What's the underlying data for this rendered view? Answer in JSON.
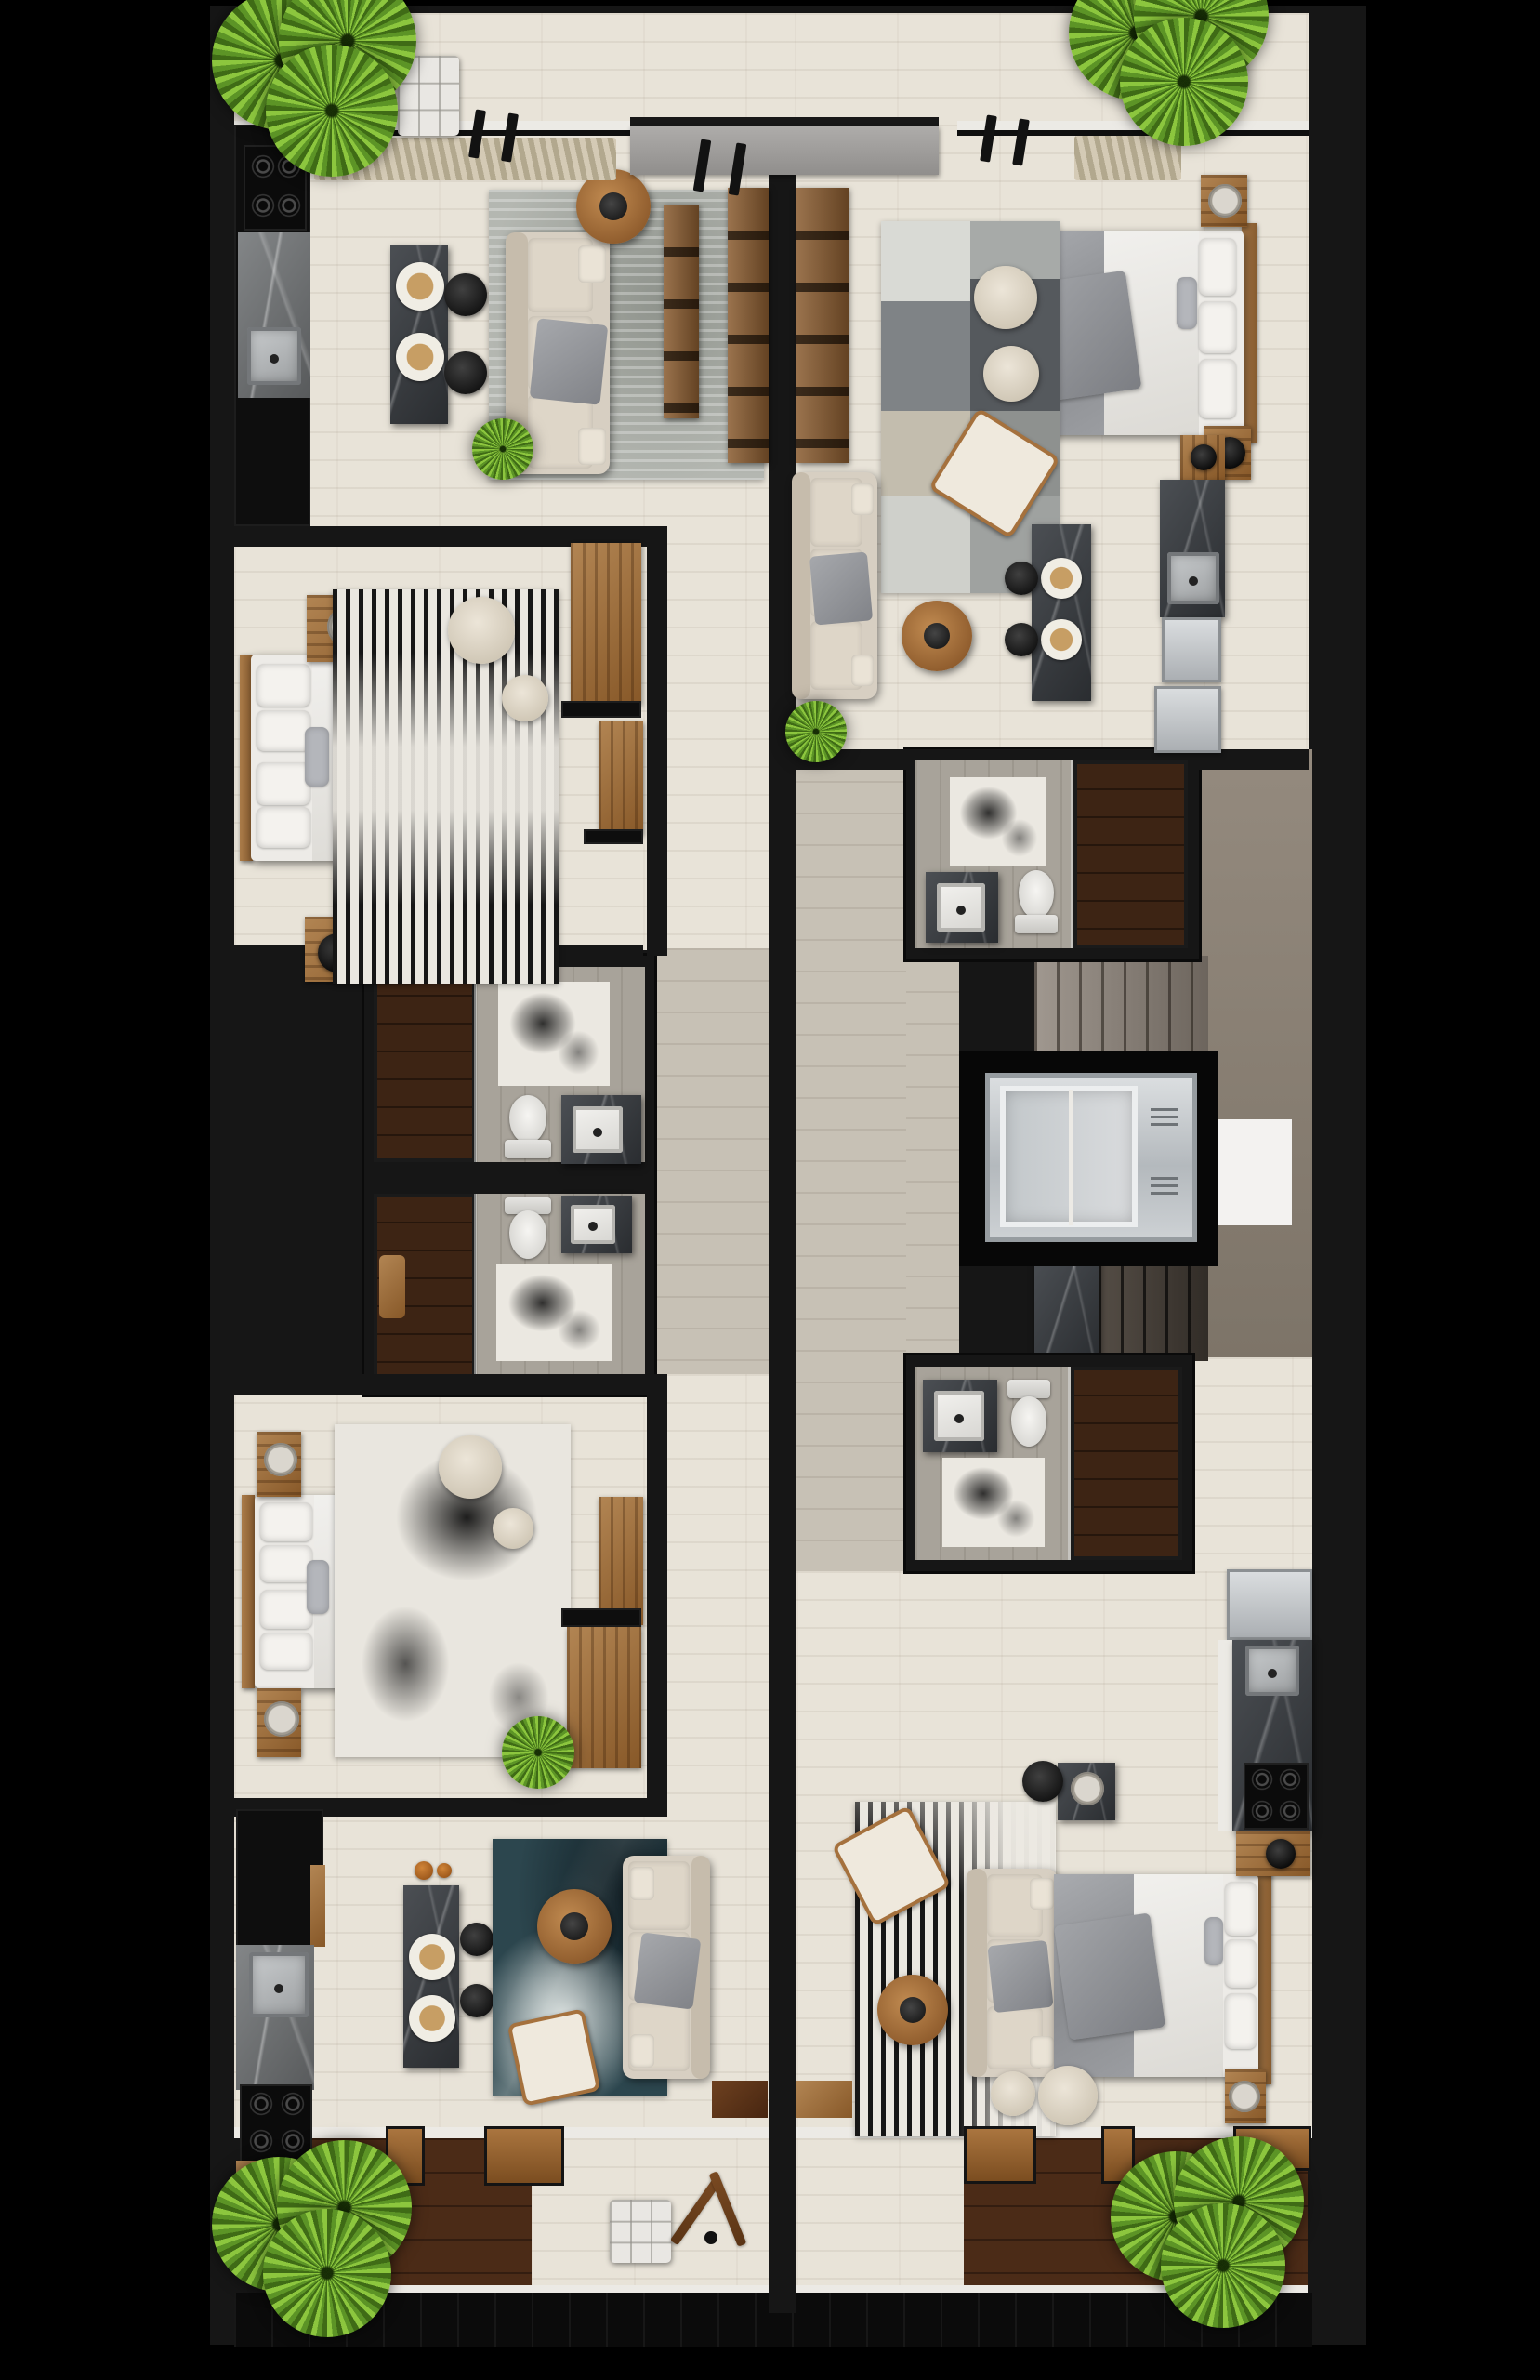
{
  "meta": {
    "title": "Residential floor plan — top-down 3D render",
    "view": "top-down",
    "style": "photorealistic 3D floor plan on black background",
    "apartments": 4,
    "shared_core": true
  },
  "palette": {
    "background": "#000000",
    "wall": "#161616",
    "floor_plank": "#e8e3d8",
    "hall_tile": "#c7c1b5",
    "bath_tile": "#a8a39a",
    "shower_wood": "#3d2414",
    "deck_wood": "#4b2b17",
    "warm_wood": "#a06a3b",
    "light_wood": "#b28553",
    "marble_dark": "#3c4045",
    "marble_gray": "#75787a",
    "sofa_beige": "#d7cfc2",
    "bedding_white": "#edebe7",
    "blanket_gray": "#97999d",
    "rug_gray": "#b4b7b1",
    "rug_blue": "#2c464e",
    "pouf_cream": "#e3dccd",
    "stool_black": "#242424",
    "plant_green": "#5c9426",
    "plant_light": "#8cc63e",
    "plant_dark": "#3f6b16",
    "elevator_silver": "#dde0e2",
    "stairs_taupe": "#8b8177",
    "concrete": "#8a8175",
    "curtain_beige": "#c9bfa7",
    "sill_white": "#eceae5"
  },
  "units": {
    "top_left": {
      "label": "Unit 1 · top-left · one-bedroom apartment",
      "rooms": [
        "open kitchen & dining",
        "living room",
        "bedroom",
        "bathroom",
        "balcony"
      ],
      "furniture": [
        "gas cooktop",
        "kitchen sink",
        "gray marble counter",
        "dark marble dining island",
        "2 place settings",
        "2 black bar stools",
        "beige sofa with gray throw",
        "gray area rug",
        "round wood coffee table",
        "TV shelf console",
        "double-sided wood media console",
        "tufted white ottoman",
        "window curtains",
        "double bed",
        "2 wood nightstands",
        "table lamp",
        "glass tray",
        "black & white striped rug",
        "2 round poufs",
        "wardrobe",
        "dresser",
        "walk-in shower",
        "toilet",
        "stone vanity with basin",
        "bath mat",
        "wood shower stool"
      ]
    },
    "top_right": {
      "label": "Unit 2 · top-right · one-bedroom apartment",
      "rooms": [
        "bedroom area",
        "living room",
        "kitchen",
        "bathroom",
        "entry"
      ],
      "furniture": [
        "double bed with gray blanket",
        "wood headboard",
        "2 nightstands",
        "black table lamp",
        "patchwork gray rug",
        "2 round poufs",
        "woven lounge chair",
        "beige sofa",
        "round wood coffee table",
        "dark marble dining island",
        "2 place settings",
        "2 black bar stools",
        "marble kitchen counter with sink",
        "2 silver appliance fronts",
        "wood wall shelf",
        "window curtains",
        "walk-in shower",
        "toilet",
        "stone vanity with basin",
        "bath mat",
        "small potted plant"
      ]
    },
    "bottom_left": {
      "label": "Unit 3 · bottom-left · one-bedroom apartment",
      "rooms": [
        "bedroom",
        "open kitchen & living room",
        "bathroom",
        "balcony",
        "entry"
      ],
      "furniture": [
        "double bed",
        "2 wood nightstands",
        "candle tray",
        "abstract black & white rug",
        "2 round poufs",
        "dresser",
        "wood desk",
        "small spiky plant",
        "black fridge column",
        "marble counter with sink",
        "gas cooktop",
        "dark marble dining island",
        "2 place settings",
        "2 black bar stools",
        "2 orange vases",
        "blue abstract rug",
        "round wood coffee table",
        "white lounge chair",
        "beige sofa",
        "tufted white ottoman",
        "wooden easel stand",
        "2 balcony benches"
      ]
    },
    "bottom_right": {
      "label": "Unit 4 · bottom-right · one-bedroom apartment",
      "rooms": [
        "bedroom & living area",
        "kitchen",
        "bathroom",
        "balcony",
        "entry"
      ],
      "furniture": [
        "double bed with gray blanket",
        "wood headboard",
        "beige sofa",
        "black & white striped rug",
        "round wood coffee table",
        "woven lounge chair",
        "2 round poufs",
        "marble pedestal side table",
        "black round stool",
        "2 wood nightstands",
        "black table lamp",
        "silver fridge",
        "marble counter with sink",
        "gas cooktop",
        "walk-in shower",
        "toilet",
        "stone vanity with basin",
        "bath mat",
        "3 balcony benches"
      ]
    }
  },
  "core": {
    "label": "Shared circulation core",
    "elevator_label": "Elevator cabin",
    "stairs_up_label": "Staircase — upper flight",
    "stairs_down_label": "Staircase — lower flight",
    "landing_label": "Concrete stair landing",
    "corridor_label": "Shared corridor / unit hallways",
    "divider_label": "Central party wall"
  },
  "counts": {
    "bathrooms": 4,
    "beds": 4,
    "sofas": 4,
    "dining_islands": 3,
    "large_corner_plants": 4,
    "small_plants": 3,
    "balconies": 3
  }
}
